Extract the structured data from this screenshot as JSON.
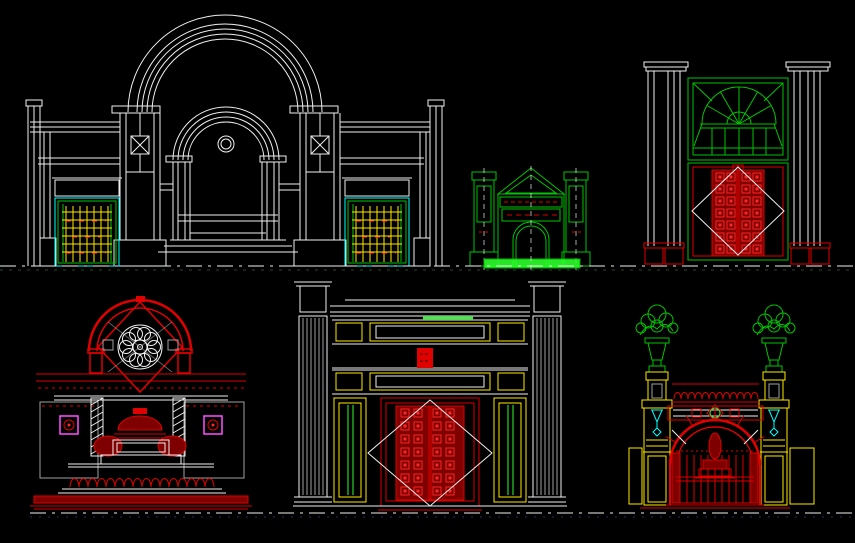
{
  "app": {
    "type": "cad-model-space",
    "background": "#000000",
    "canvas": {
      "width": 855,
      "height": 543
    }
  },
  "palette": {
    "white": "#f0f0f0",
    "gray": "#9f9f9f",
    "red": "#e00000",
    "red_bright": "#ff2626",
    "red_dark": "#7e0000",
    "green": "#00c400",
    "green_bright": "#2bff2b",
    "cyan": "#00ffff",
    "yellow": "#ffe800",
    "magenta": "#ff4fff",
    "dim_green": "#2f5b2f",
    "dim_blue": "#26406e"
  },
  "drawings": [
    {
      "id": "grand-arched-gate",
      "label": "Grand arched gate elevation with lattice side doors",
      "position": "top-left",
      "primary_color": "white",
      "accent_colors": [
        "cyan",
        "green",
        "yellow",
        "red",
        "magenta"
      ]
    },
    {
      "id": "green-memorial-gate",
      "label": "Pedimented gate elevation",
      "position": "top-center",
      "primary_color": "green",
      "accent_colors": [
        "red",
        "white"
      ]
    },
    {
      "id": "fanlight-door-gate",
      "label": "Fanlight window over studded double door",
      "position": "top-right",
      "primary_color": "green",
      "accent_colors": [
        "red",
        "white"
      ]
    },
    {
      "id": "rose-window-fountain-wall",
      "label": "Rose window arch with fountain and balustrade",
      "position": "bottom-left",
      "primary_color": "red",
      "accent_colors": [
        "white",
        "magenta"
      ]
    },
    {
      "id": "paneled-pylon-gate",
      "label": "Pylon gate with studded double door",
      "position": "bottom-center",
      "primary_color": "white",
      "accent_colors": [
        "red",
        "yellow",
        "green"
      ]
    },
    {
      "id": "urn-arch-gate",
      "label": "Arched gate with planter urns and lamps",
      "position": "bottom-right",
      "primary_color": "red",
      "accent_colors": [
        "green",
        "yellow",
        "cyan"
      ]
    }
  ],
  "reference_lines": [
    {
      "id": "upper-ground-line",
      "y": 266,
      "style": "dash-dot",
      "color": "white"
    },
    {
      "id": "lower-ground-line",
      "y": 513,
      "style": "dash-dot",
      "color": "white"
    }
  ]
}
